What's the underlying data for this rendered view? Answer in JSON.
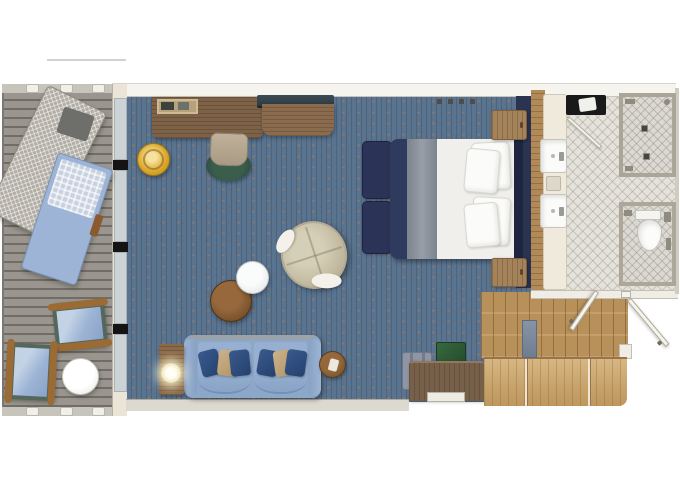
{
  "app": {
    "name": "cruise-suite-floor-plan",
    "kind": "floorplan-diagram"
  },
  "visible_text": [],
  "palette": {
    "background": "#ffffff",
    "carpet_blue": "#5a7490",
    "deck_gray": "#93908a",
    "wall_light": "#f6f4ee",
    "glass_blue": "#ccd3d7",
    "mullion_black": "#141414",
    "wood_furniture": "#7e6248",
    "wood_entry_oak": "#b8905a",
    "wood_closet": "#c9a367",
    "bed_navy": "#2e3a5e",
    "bed_runner_gray": "#8e949e",
    "linen_white": "#f0efec",
    "headboard_navy": "#1e2540",
    "sofa_blue": "#8da7c9",
    "pillow_navy": "#2d4a77",
    "pillow_tan": "#c2a67c",
    "bath_tile": "#e4e2da",
    "stool_gold": "#ddab30",
    "desk_chair_green": "#2e4f40",
    "chest_green": "#2e5c39",
    "bath_mat_black": "#191919",
    "lounger_blue": "#9db4d6"
  },
  "rooms": {
    "balcony": {
      "label": "balcony",
      "items": [
        "net-covered-lounger",
        "sun-lounger",
        "deck-chair",
        "deck-chair",
        "round-side-table"
      ]
    },
    "living_bedroom": {
      "label": "living and sleeping area",
      "items": [
        "desk",
        "desk-tray",
        "desk-chair",
        "gold-ottoman",
        "tv",
        "tv-cabinet",
        "double-bed",
        "bed-pillows",
        "foot-cushions",
        "headboard",
        "nightstand",
        "nightstand",
        "swivel-armchair",
        "coffee-table-white",
        "coffee-table-brown",
        "sofa",
        "sofa-pillows",
        "side-table-with-lamp",
        "round-side-table",
        "luggage-rack",
        "green-chest",
        "dresser-with-tray"
      ]
    },
    "bathroom": {
      "label": "bathroom",
      "items": [
        "vanity-counter",
        "sink",
        "sink",
        "soap-tray",
        "bath-mat-with-towel",
        "glass-partition"
      ]
    },
    "shower_room": {
      "label": "shower room",
      "items": [
        "floor-drain",
        "floor-drain",
        "shower-fixtures"
      ]
    },
    "wc_room": {
      "label": "toilet room",
      "items": [
        "toilet"
      ]
    },
    "entry": {
      "label": "entry hall",
      "items": [
        "entry-door",
        "bathroom-door",
        "tall-cabinet"
      ]
    },
    "closet": {
      "label": "wardrobe closet",
      "items": [
        "wardrobe-panel",
        "wardrobe-panel",
        "wardrobe-panel"
      ]
    }
  }
}
